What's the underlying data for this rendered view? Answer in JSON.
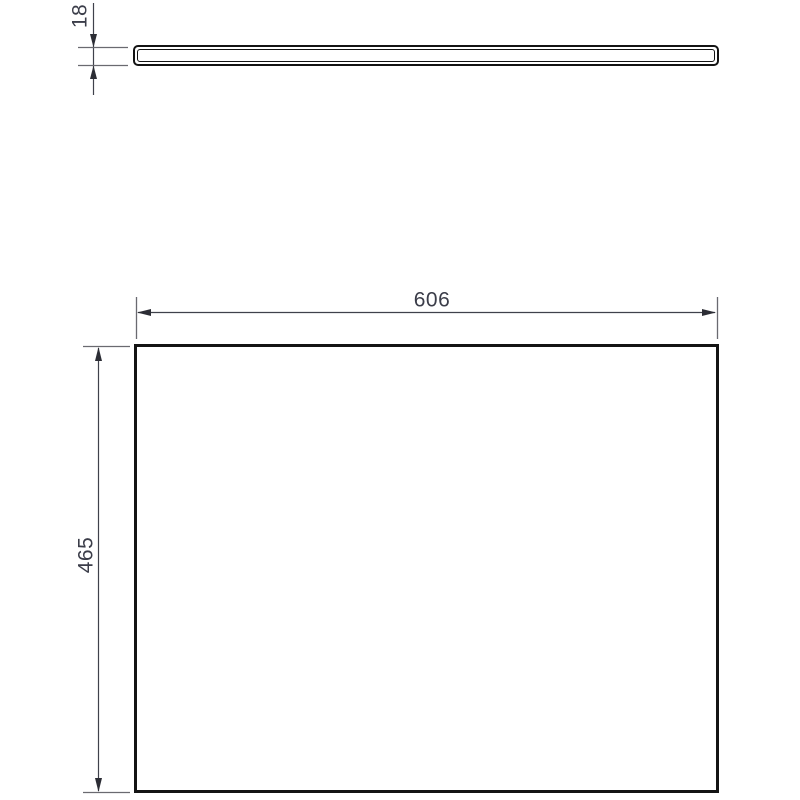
{
  "drawing": {
    "dimensions": {
      "thickness_label": "18",
      "width_label": "606",
      "height_label": "465"
    },
    "colors": {
      "outline": "#141414",
      "dimension_line": "#3f414b",
      "extension_line": "#6a6a70",
      "label_text": "#3b3d49",
      "background": "#ffffff"
    }
  }
}
